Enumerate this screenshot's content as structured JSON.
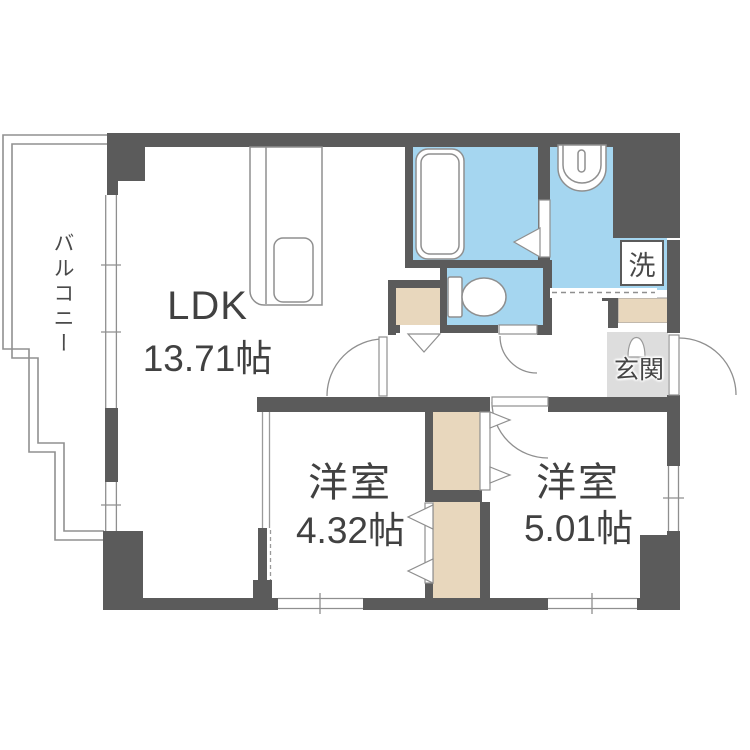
{
  "plan": {
    "balcony_label": "バルコニー",
    "ldk_label": "LDK",
    "ldk_size": "13.71帖",
    "bedroom1_label": "洋室",
    "bedroom1_size": "4.32帖",
    "bedroom2_label": "洋室",
    "bedroom2_size": "5.01帖",
    "entrance_label": "玄関",
    "laundry_label": "洗"
  },
  "colors": {
    "wall": "#5b5b5b",
    "wet_area_floor": "#a5d6f0",
    "closet_floor": "#e8d7bd",
    "entrance_floor": "#dddddd",
    "fixture_line": "#8f8f8f",
    "text": "#414141",
    "background": "#ffffff"
  }
}
